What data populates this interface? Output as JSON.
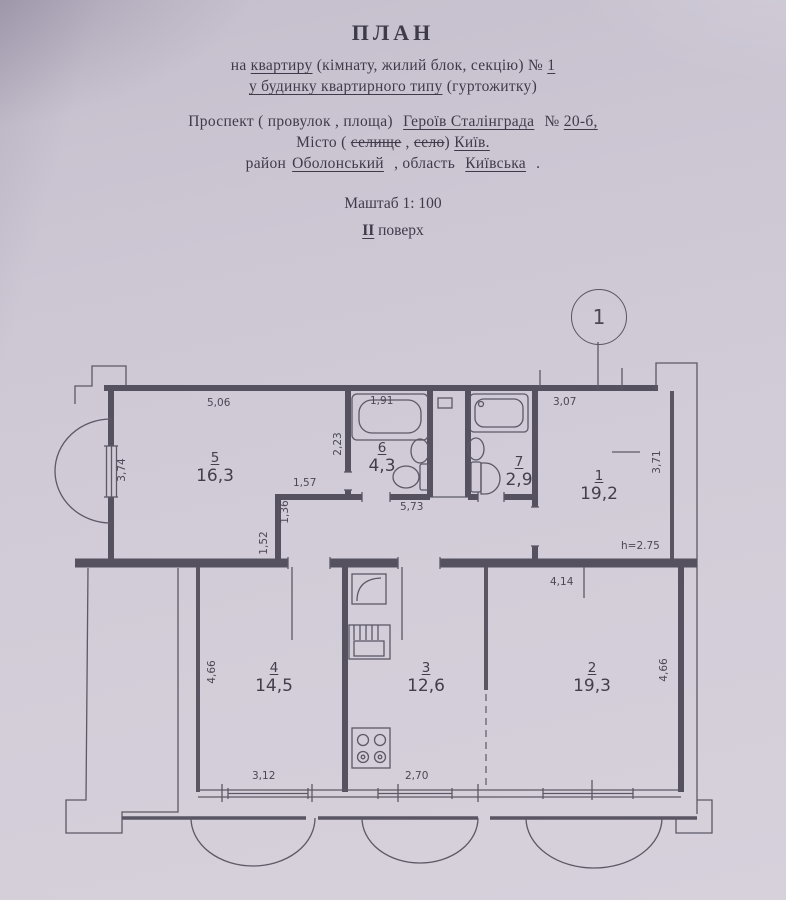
{
  "header": {
    "title": "ПЛАН",
    "line1_pre": "на ",
    "line1_u": "квартиру",
    "line1_mid": " (кімнату, жилий блок, секцію) № ",
    "line1_num": "1",
    "line2_u": "у будинку квартирного типу",
    "line2_post": " (гуртожитку)",
    "addr_pre": "Проспект ( провулок , площа)  ",
    "addr_street": "Героїв Сталінграда",
    "addr_no_label": "  № ",
    "addr_no": "20-б,",
    "city_pre": "Місто ( ",
    "city_s1": "селище",
    "city_comma": " , ",
    "city_s2": "село",
    "city_close": ") ",
    "city_name": "Київ.",
    "district_label": "район",
    "district": "Оболонський",
    "region_label": " , область ",
    "region": "Київська",
    "region_post": " .",
    "scale": "Маштаб 1: 100",
    "floor_num": "II",
    "floor_label": " поверх"
  },
  "plan": {
    "axis_marker": "1",
    "rooms": [
      {
        "num": "5",
        "area": "16,3"
      },
      {
        "num": "6",
        "area": "4,3"
      },
      {
        "num": "7",
        "area": "2,9"
      },
      {
        "num": "1",
        "area": "19,2"
      },
      {
        "num": "4",
        "area": "14,5"
      },
      {
        "num": "3",
        "area": "12,6"
      },
      {
        "num": "2",
        "area": "19,3"
      }
    ],
    "dims": {
      "d506": "5,06",
      "d191": "1,91",
      "d307": "3,07",
      "d374": "3,74",
      "d223": "2,23",
      "d157": "1,57",
      "d136": "1,36",
      "d152": "1,52",
      "d573": "5,73",
      "d371": "3,71",
      "h275": "h=2.75",
      "d414": "4,14",
      "d466l": "4,66",
      "d466r": "4,66",
      "d312": "3,12",
      "d270": "2,70"
    }
  }
}
